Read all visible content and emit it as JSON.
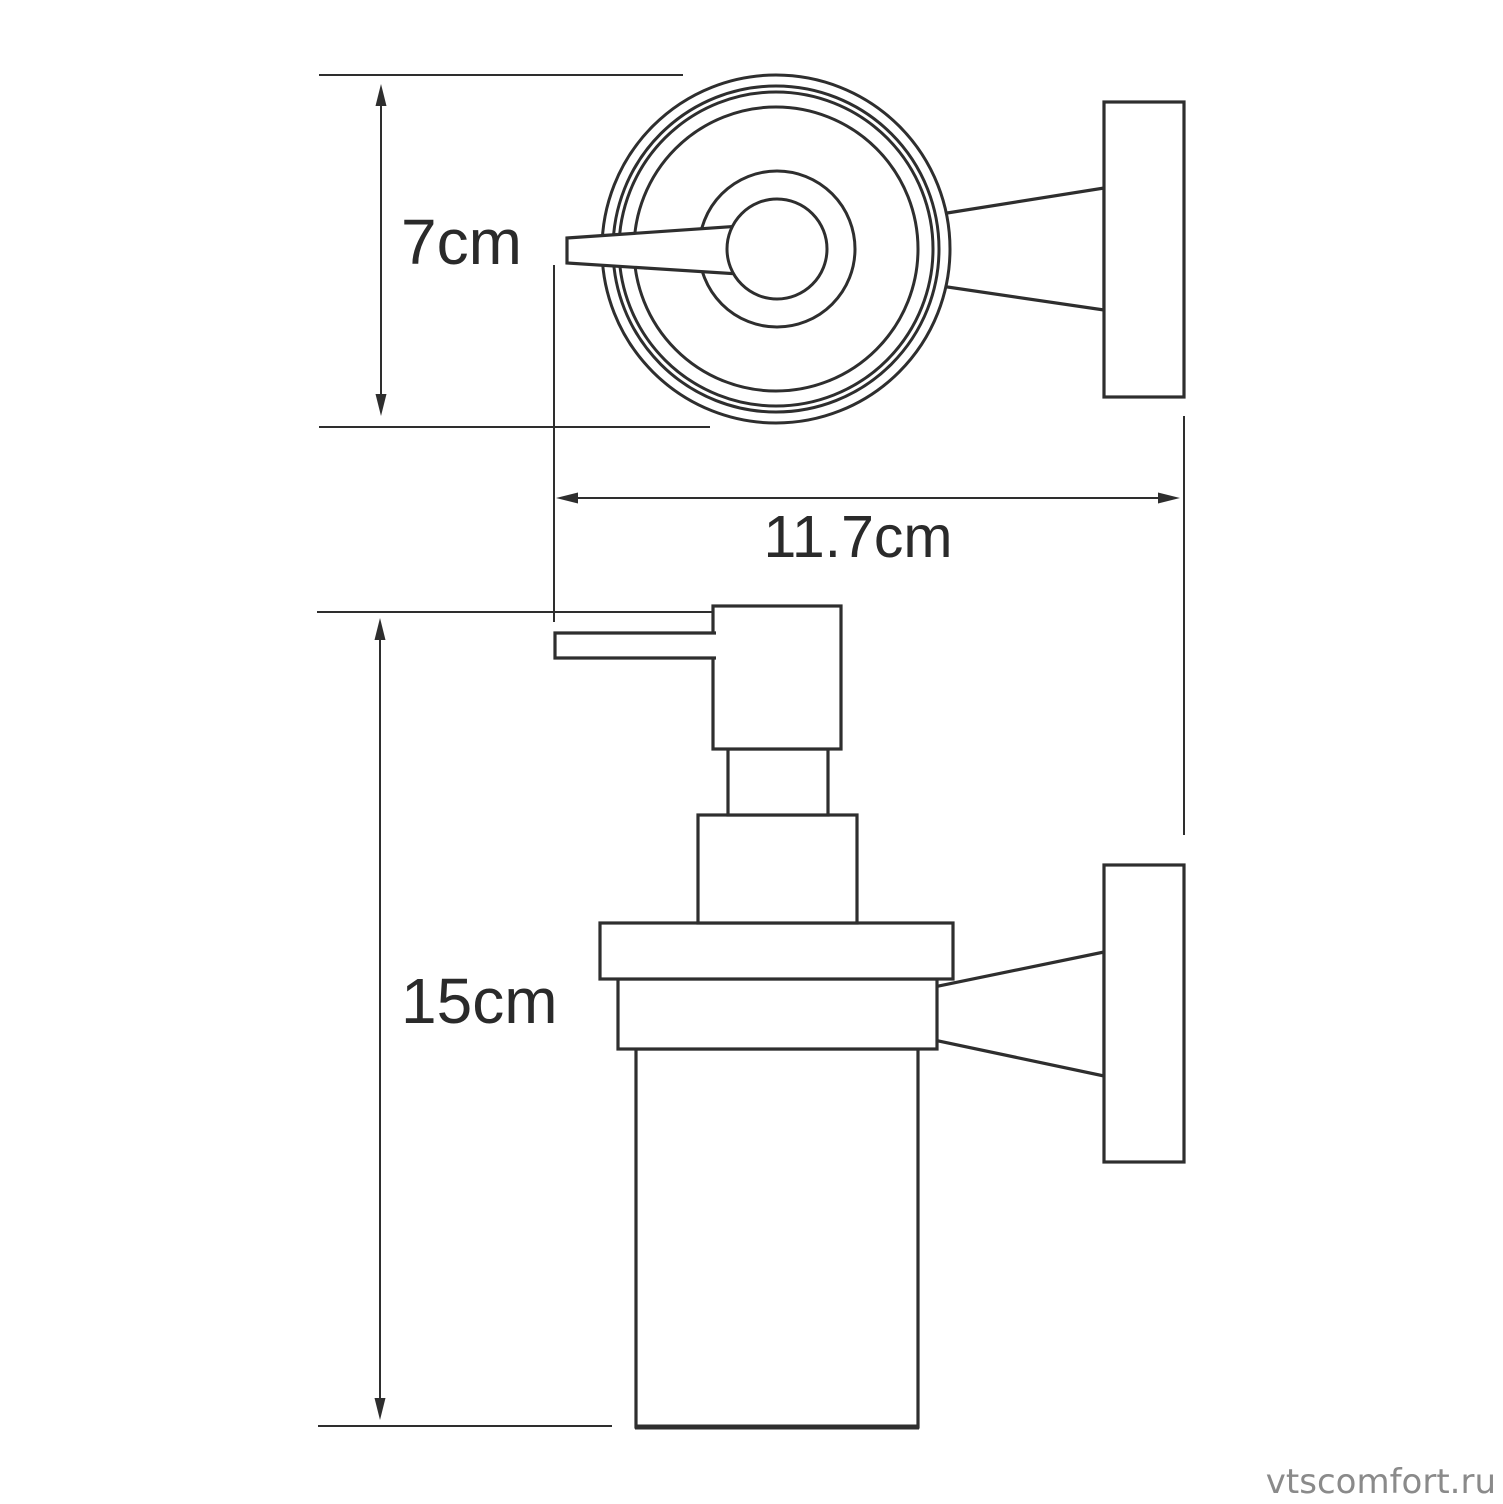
{
  "colors": {
    "background": "#ffffff",
    "line": "#2e2e2e",
    "text": "#2a2a2a",
    "watermark": "#8a8a8a"
  },
  "watermark": {
    "text": "vtscomfort.ru"
  },
  "dimensions": [
    {
      "label": "7cm",
      "value": 7,
      "unit": "cm",
      "orientation": "vertical"
    },
    {
      "label": "11.7cm",
      "value": 11.7,
      "unit": "cm",
      "orientation": "horizontal"
    },
    {
      "label": "15cm",
      "value": 15,
      "unit": "cm",
      "orientation": "vertical"
    }
  ]
}
